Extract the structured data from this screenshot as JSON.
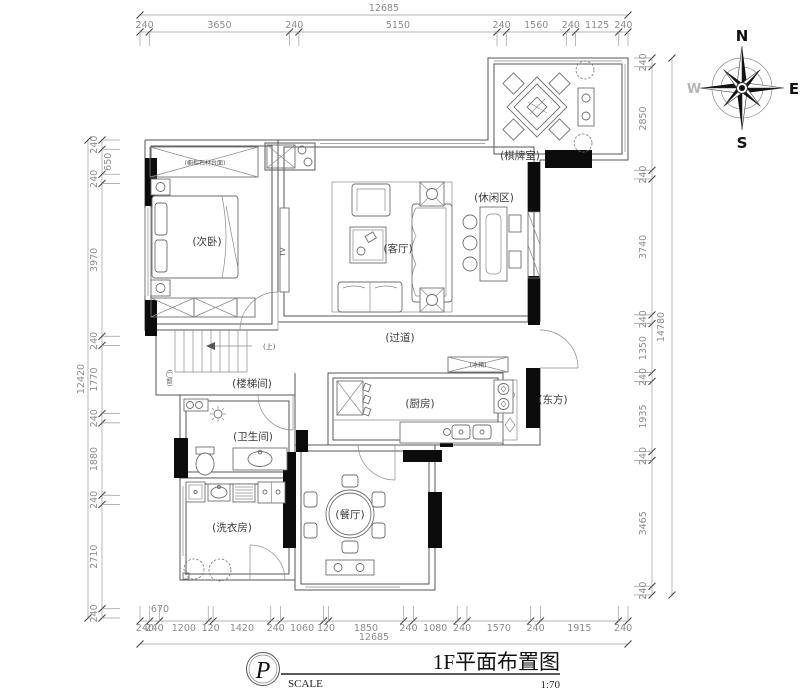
{
  "drawing": {
    "type": "floor-plan",
    "colors": {
      "wall_fill": "#0c0c0c",
      "line": "#555555",
      "dim_text": "#8b8b8b"
    }
  },
  "title_block": {
    "logo": "P",
    "scale_label": "SCALE",
    "title": "1F平面布置图",
    "scale_value": "1:70"
  },
  "compass": {
    "n": "N",
    "e": "E",
    "s": "S",
    "w": "W"
  },
  "rooms": {
    "bedroom": "(次卧)",
    "closet_note": "(橱柜石材台面)",
    "tv": "TV",
    "living": "(客厅)",
    "leisure": "(休闲区)",
    "chess": "(棋牌室)",
    "corridor": "(过道)",
    "kitchen": "(厨房)",
    "fridge": "(冰箱)",
    "east": "(东方)",
    "stairwell": "(楼梯间)",
    "up": "(上)",
    "stair_door": "(暗门)",
    "bathroom": "(卫生间)",
    "laundry": "(洗衣房)",
    "dining": "(餐厅)"
  },
  "dimensions": {
    "top": {
      "total": "12685",
      "segments": [
        "240",
        "3650",
        "240",
        "5150",
        "240",
        "1560",
        "240",
        "1125",
        "240"
      ]
    },
    "bottom": {
      "total": "12685",
      "inner": "670",
      "segments": [
        "240",
        "240",
        "1200",
        "120",
        "1420",
        "240",
        "1060",
        "120",
        "1850",
        "240",
        "1080",
        "240",
        "1570",
        "240",
        "1915",
        "240"
      ]
    },
    "left": {
      "total": "12420",
      "segments": [
        "240",
        "650",
        "240",
        "3970",
        "240",
        "1770",
        "240",
        "1880",
        "240",
        "2710",
        "240"
      ]
    },
    "right": {
      "total": "14780",
      "segments": [
        "240",
        "2850",
        "240",
        "3740",
        "240",
        "1350",
        "240",
        "1935",
        "240",
        "3465",
        "240"
      ]
    }
  }
}
